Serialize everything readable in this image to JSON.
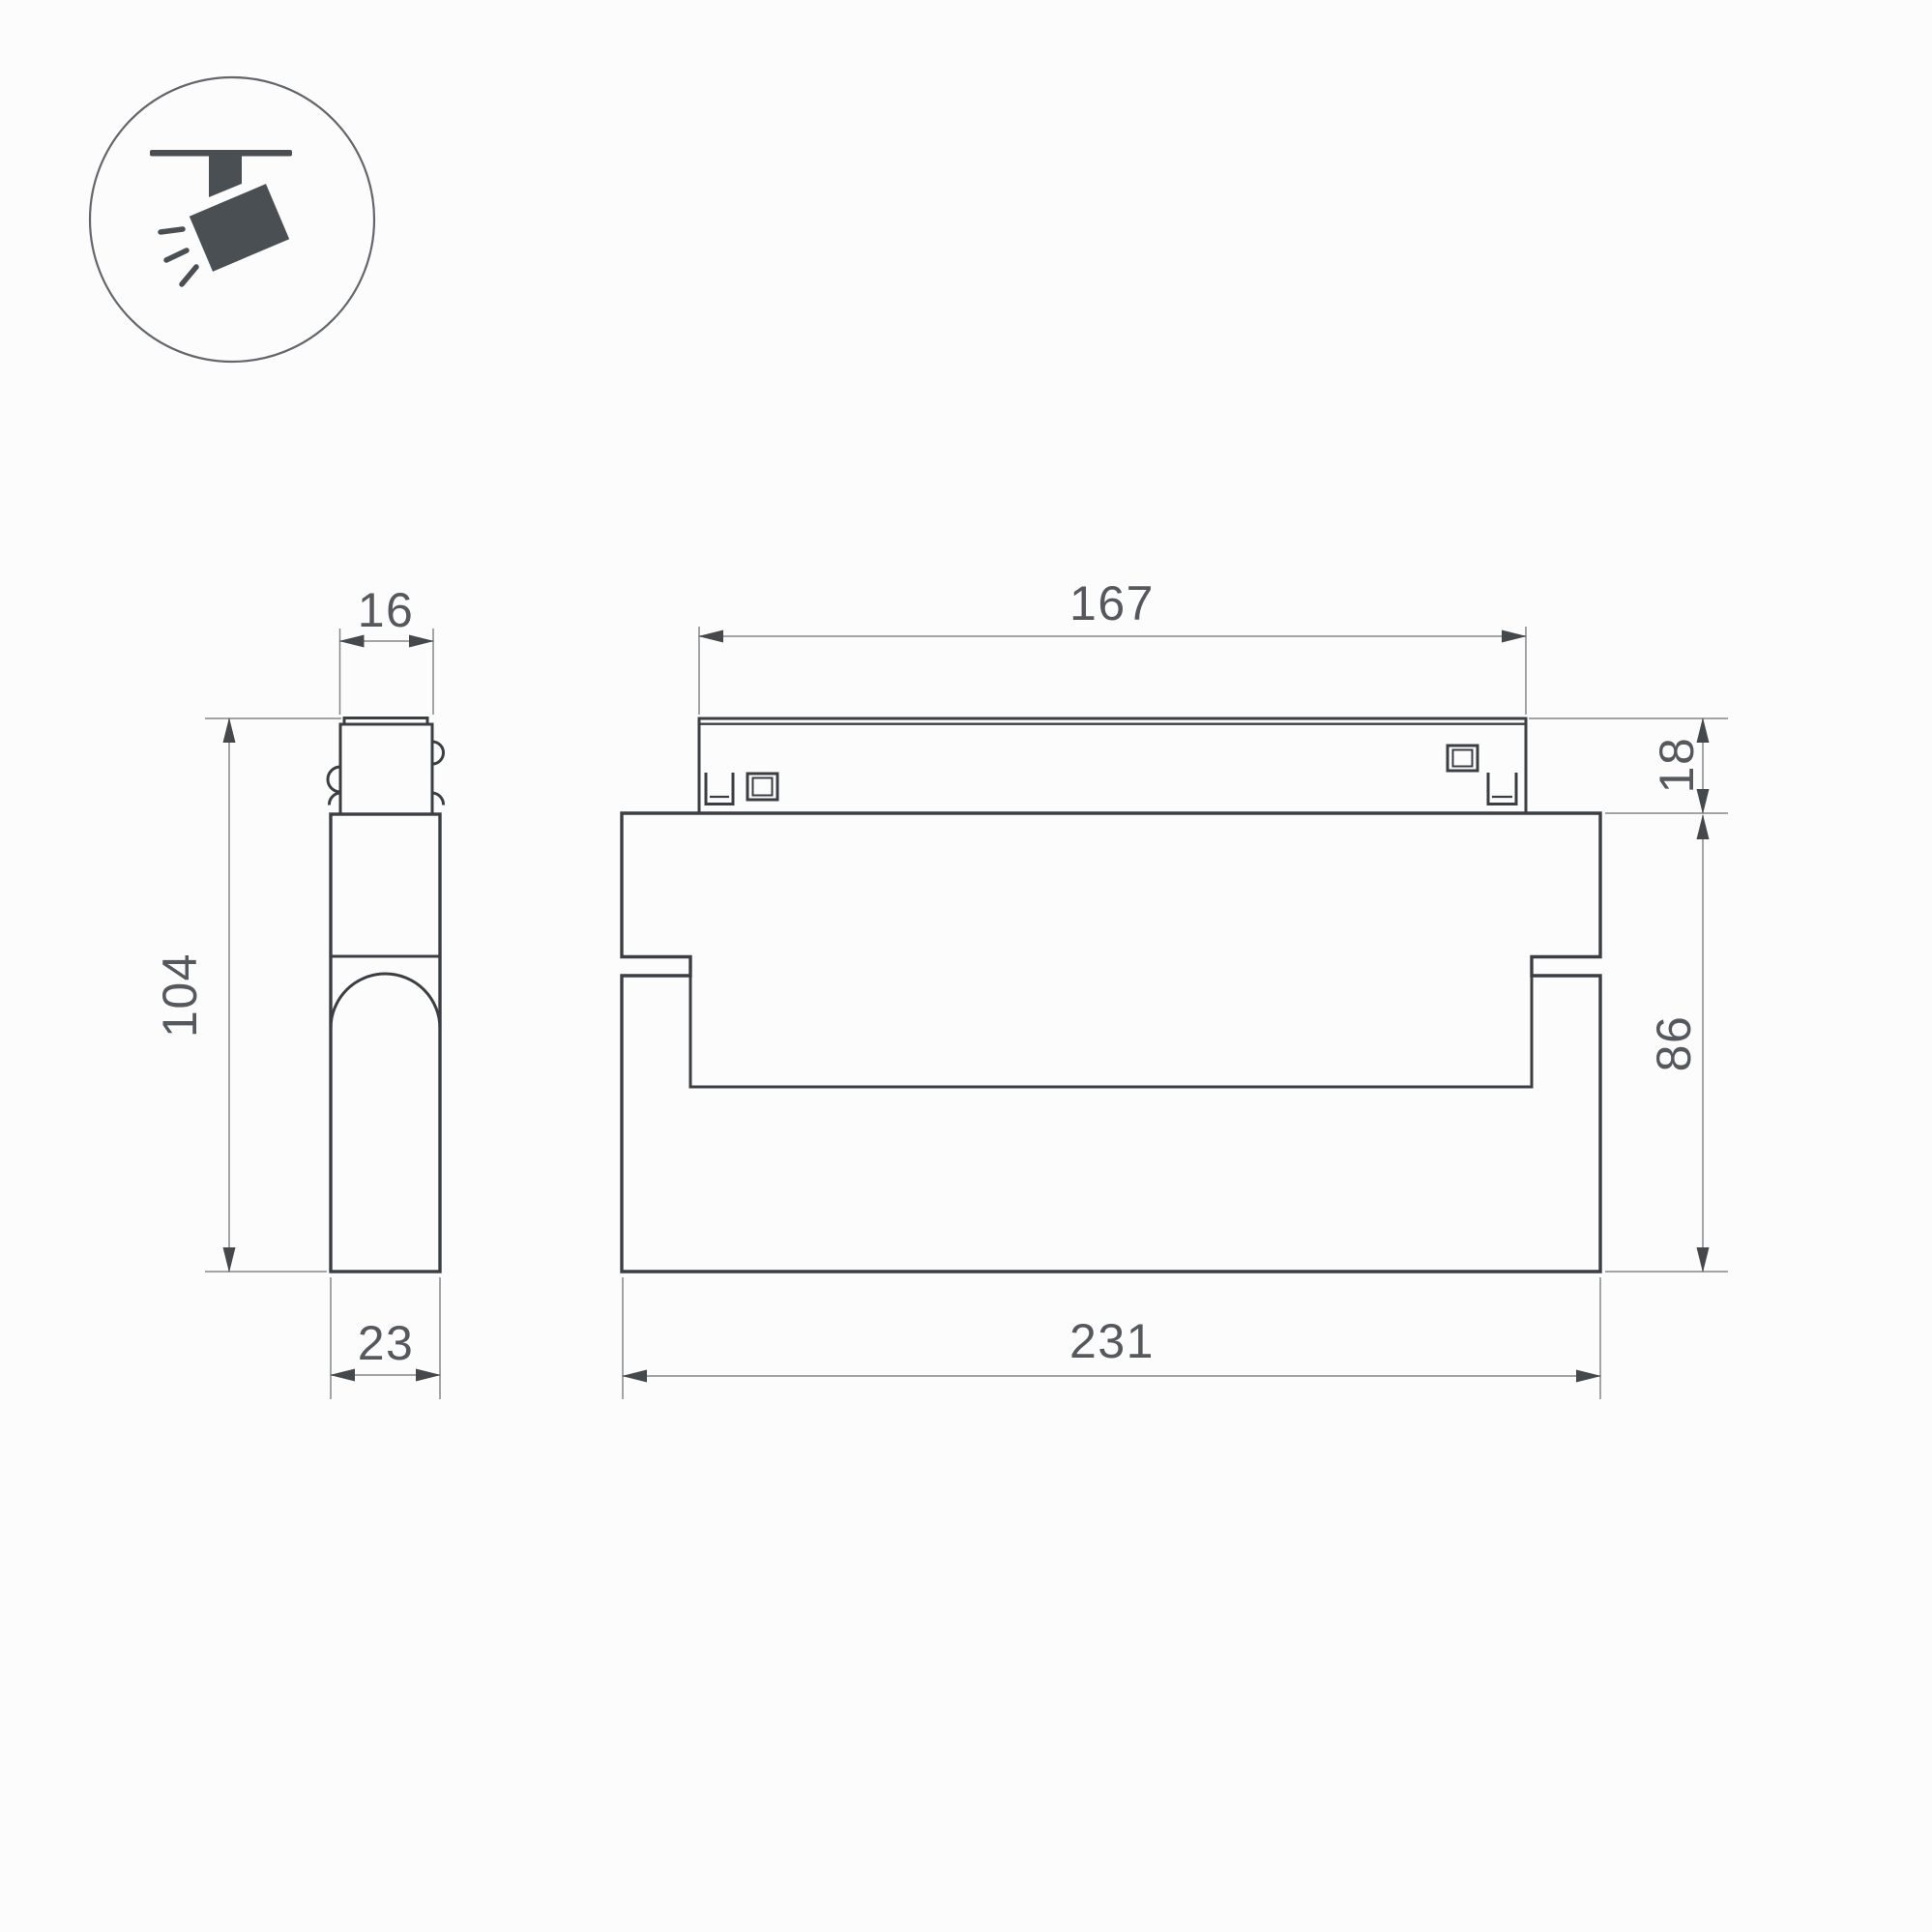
{
  "drawing": {
    "type": "technical-dimension-drawing",
    "product": "magnetic track folding spot luminaire"
  },
  "icon": {
    "name": "ceiling-track-spotlight",
    "glyph_color": "#4a4f54",
    "ring_color": "#63676b"
  },
  "style": {
    "background": "#fcfcfc",
    "outline_color": "#3b3f43",
    "dim_color": "#84878a",
    "arrow_color": "#45494c",
    "text_color": "#55585c"
  },
  "views": {
    "side": {
      "label": "side-view",
      "dims": {
        "top_width": "16",
        "height": "104",
        "depth": "23"
      }
    },
    "front": {
      "label": "front-view",
      "dims": {
        "track_length": "167",
        "track_height": "18",
        "body_height": "86",
        "body_length": "231"
      }
    }
  }
}
